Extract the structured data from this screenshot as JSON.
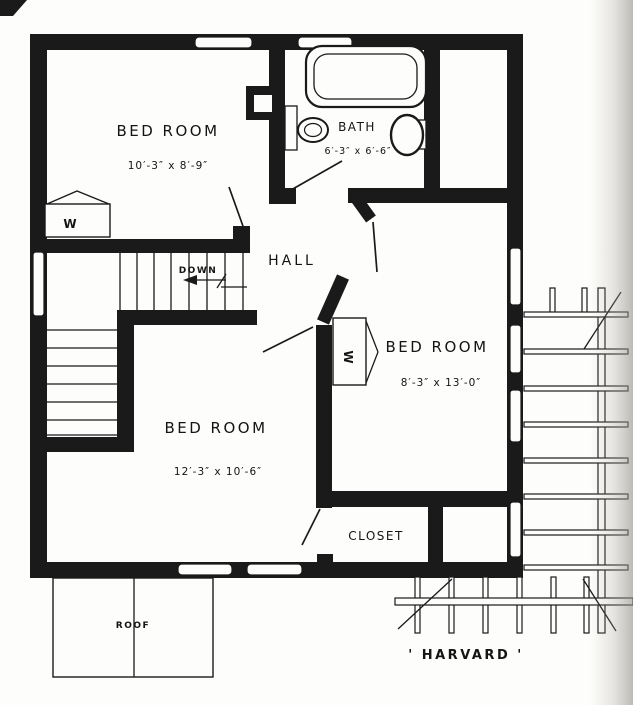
{
  "plan": {
    "name_label": "' HARVARD '",
    "rooms": {
      "bedroom_nw": {
        "label": "BED ROOM",
        "dims": "10′-3″ x 8′-9″"
      },
      "bath": {
        "label": "BATH",
        "dims": "6′-3″ x 6′-6″"
      },
      "bedroom_e": {
        "label": "BED ROOM",
        "dims": "8′-3″ x 13′-0″"
      },
      "bedroom_s": {
        "label": "BED ROOM",
        "dims": "12′-3″ x 10′-6″"
      },
      "hall": {
        "label": "HALL"
      },
      "closet": {
        "label": "CLOSET"
      }
    },
    "stairs": {
      "direction_label": "DOWN"
    },
    "wardrobe_label": "W",
    "roof_label": "ROOF",
    "colors": {
      "ink": "#1a1a1a",
      "paper": "#fdfdfb"
    }
  }
}
